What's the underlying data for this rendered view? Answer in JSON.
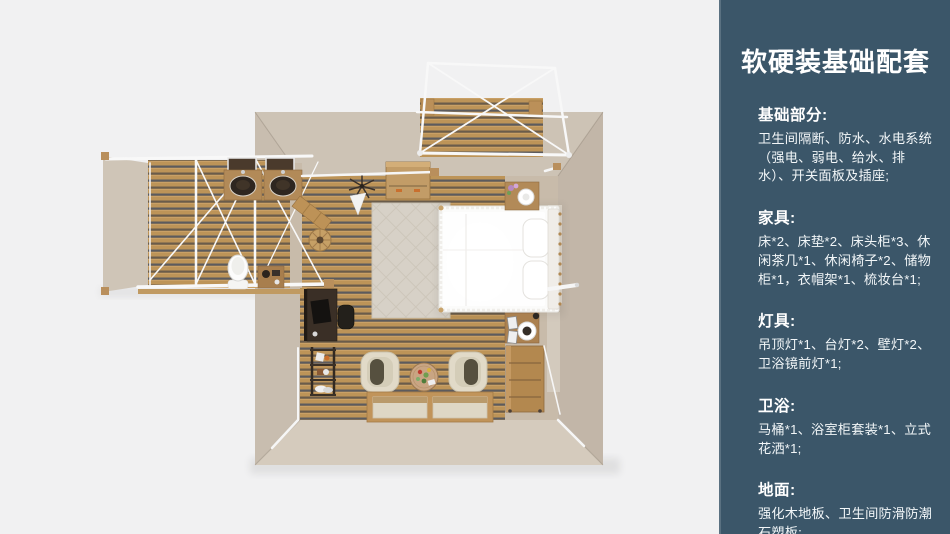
{
  "page": {
    "background_color": "#f1f1f2"
  },
  "sidebar": {
    "background_color": "#3b5669",
    "text_color": "#ffffff",
    "title": "软硬装基础配套",
    "sections": [
      {
        "heading": "基础部分:",
        "body": "卫生间隔断、防水、水电系统（强电、弱电、给水、排水）、开关面板及插座;"
      },
      {
        "heading": "家具:",
        "body": "床*2、床垫*2、床头柜*3、休闲茶几*1、休闲椅子*2、储物柜*1，衣帽架*1、梳妆台*1;"
      },
      {
        "heading": "灯具:",
        "body": "吊顶灯*1、台灯*2、壁灯*2、卫浴镜前灯*1;"
      },
      {
        "heading": "卫浴:",
        "body": "马桶*1、浴室柜套装*1、立式花洒*1;"
      },
      {
        "heading": "地面:",
        "body": "强化木地板、卫生间防滑防潮石塑板;"
      }
    ]
  },
  "floorplan": {
    "type": "top-down-3d-render",
    "rooms": [
      "bedroom",
      "bathroom-annex",
      "terrace"
    ],
    "items": [
      "double-bed",
      "pillows",
      "headboard",
      "area-rug",
      "storage-crate",
      "coat-rack",
      "nightstand-with-table-lamp",
      "nightstand-with-mirror",
      "dresser",
      "desk",
      "desk-chair",
      "shoe-shelf",
      "lounge-chair",
      "lounge-chair",
      "round-tea-table",
      "floor-mats",
      "twin-washbasins",
      "vanity-mirrors",
      "toilet",
      "bath-stand",
      "open-door",
      "laundry-basket",
      "tent-frame-bathroom",
      "tent-frame-terrace",
      "terrace-deck"
    ],
    "colors": {
      "wall_light": "#cdc3b5",
      "wall_shade": "#c2b6a8",
      "deck_wood": "#bd9458",
      "deck_groove": "#6a5c4b",
      "floor_beige": "#c8bbaa",
      "furniture_wood": "#b28a58",
      "bed_white": "#fbfbfa",
      "frame_white": "#f8f8f8",
      "dark_furniture": "#3a2f26"
    }
  }
}
